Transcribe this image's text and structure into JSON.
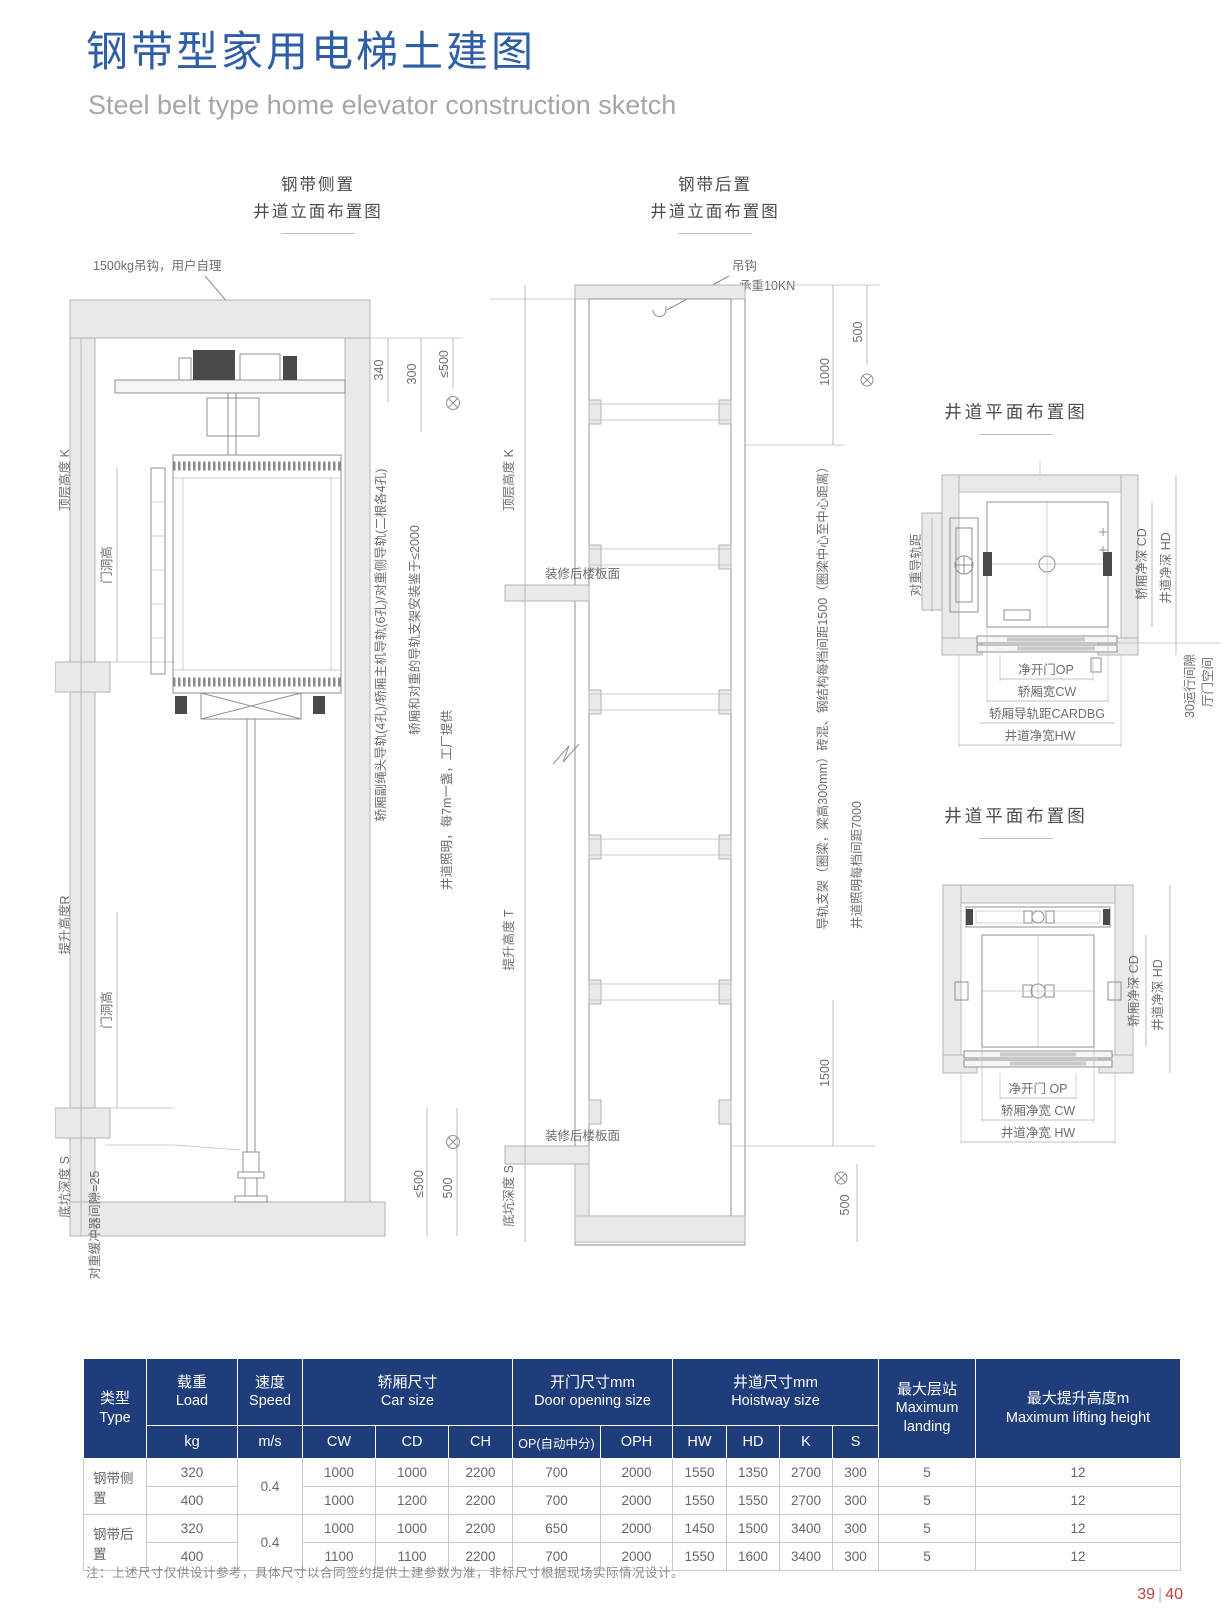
{
  "page": {
    "title": "钢带型家用电梯土建图",
    "subtitle": "Steel belt type home elevator construction sketch",
    "footnote": "注：上述尺寸仅供设计参考，具体尺寸以合同签约提供土建参数为准，非标尺寸根据现场实际情况设计。",
    "page_left": "39",
    "page_divider": "|",
    "page_right": "40"
  },
  "colors": {
    "title_blue": "#2e5ea6",
    "table_header": "#1f3d7a",
    "page_number": "#c04040"
  },
  "elev_side": {
    "title1": "钢带侧置",
    "title2": "井道立面布置图",
    "hook_label": "1500kg吊钩，用户自理",
    "dims": {
      "d340": "340",
      "d300": "300",
      "le500": "≤500",
      "le500_bot": "≤500",
      "d500_bot": "500"
    },
    "labels": {
      "rails": "轿厢副绳头导轨(4孔)/轿厢主机导轨(6孔)/对重侧导轨(二根各4孔)",
      "bracket": "轿厢和对重的导轨支架安装鉴于≤2000",
      "lighting": "井道照明，每7m一盏，工厂提供",
      "top_height": "顶层高度 K",
      "door_h1": "门洞高",
      "lift_height": "提升高度R",
      "door_h2": "门洞高",
      "pit_depth": "底坑深度 S",
      "buffer_gap": "对重缓冲器间隙=25"
    }
  },
  "elev_rear": {
    "title1": "钢带后置",
    "title2": "井道立面布置图",
    "hook1": "吊钩",
    "hook2": "承重10KN",
    "dims": {
      "d1000": "1000",
      "d500_top": "500",
      "d1500": "1500",
      "d500_bot": "500"
    },
    "labels": {
      "beams": "导轨支架（圈梁，梁高300mm）砖混、钢结构每档间距1500（圈梁中心至中心距离）",
      "lighting": "井道照明每档间距7000",
      "top_height": "顶层高度 K",
      "floor_top": "装修后楼板面",
      "lift_height": "提升高度 T",
      "pit_depth": "底坑深度 S",
      "floor_bot": "装修后楼板面"
    }
  },
  "plan_top": {
    "title": "井道平面布置图",
    "labels": {
      "cwt_rail": "对重导轨距",
      "car_depth": "轿厢净深 CD",
      "shaft_depth": "井道净深 HD",
      "op": "净开门OP",
      "cw": "轿厢宽CW",
      "cardbg": "轿厢导轨距CARDBG",
      "hw": "井道净宽HW",
      "run_gap": "30运行间隙",
      "door_space": "厅门空间"
    }
  },
  "plan_bottom": {
    "title": "井道平面布置图",
    "labels": {
      "car_depth": "轿厢净深 CD",
      "shaft_depth": "井道净深 HD",
      "op": "净开门 OP",
      "cw": "轿厢净宽 CW",
      "hw": "井道净宽 HW"
    }
  },
  "table": {
    "headers": {
      "type_cn": "类型",
      "type_en": "Type",
      "load_cn": "载重",
      "load_en": "Load",
      "speed_cn": "速度",
      "speed_en": "Speed",
      "car_cn": "轿厢尺寸",
      "car_en": "Car size",
      "door_cn": "开门尺寸mm",
      "door_en": "Door opening size",
      "hoistway_cn": "井道尺寸mm",
      "hoistway_en": "Hoistway size",
      "landing_cn": "最大层站",
      "landing_en": "Maximum landing",
      "lift_cn": "最大提升高度m",
      "lift_en": "Maximum lifting height"
    },
    "sub": [
      "kg",
      "m/s",
      "CW",
      "CD",
      "CH",
      "OP(自动中分)",
      "OPH",
      "HW",
      "HD",
      "K",
      "S"
    ],
    "groups": [
      {
        "type": "钢带侧置",
        "speed": "0.4",
        "rows": [
          [
            "320",
            "1000",
            "1000",
            "2200",
            "700",
            "2000",
            "1550",
            "1350",
            "2700",
            "300",
            "5",
            "12"
          ],
          [
            "400",
            "1000",
            "1200",
            "2200",
            "700",
            "2000",
            "1550",
            "1550",
            "2700",
            "300",
            "5",
            "12"
          ]
        ]
      },
      {
        "type": "钢带后置",
        "speed": "0.4",
        "rows": [
          [
            "320",
            "1000",
            "1000",
            "2200",
            "650",
            "2000",
            "1450",
            "1500",
            "3400",
            "300",
            "5",
            "12"
          ],
          [
            "400",
            "1100",
            "1100",
            "2200",
            "700",
            "2000",
            "1550",
            "1600",
            "3400",
            "300",
            "5",
            "12"
          ]
        ]
      }
    ]
  }
}
